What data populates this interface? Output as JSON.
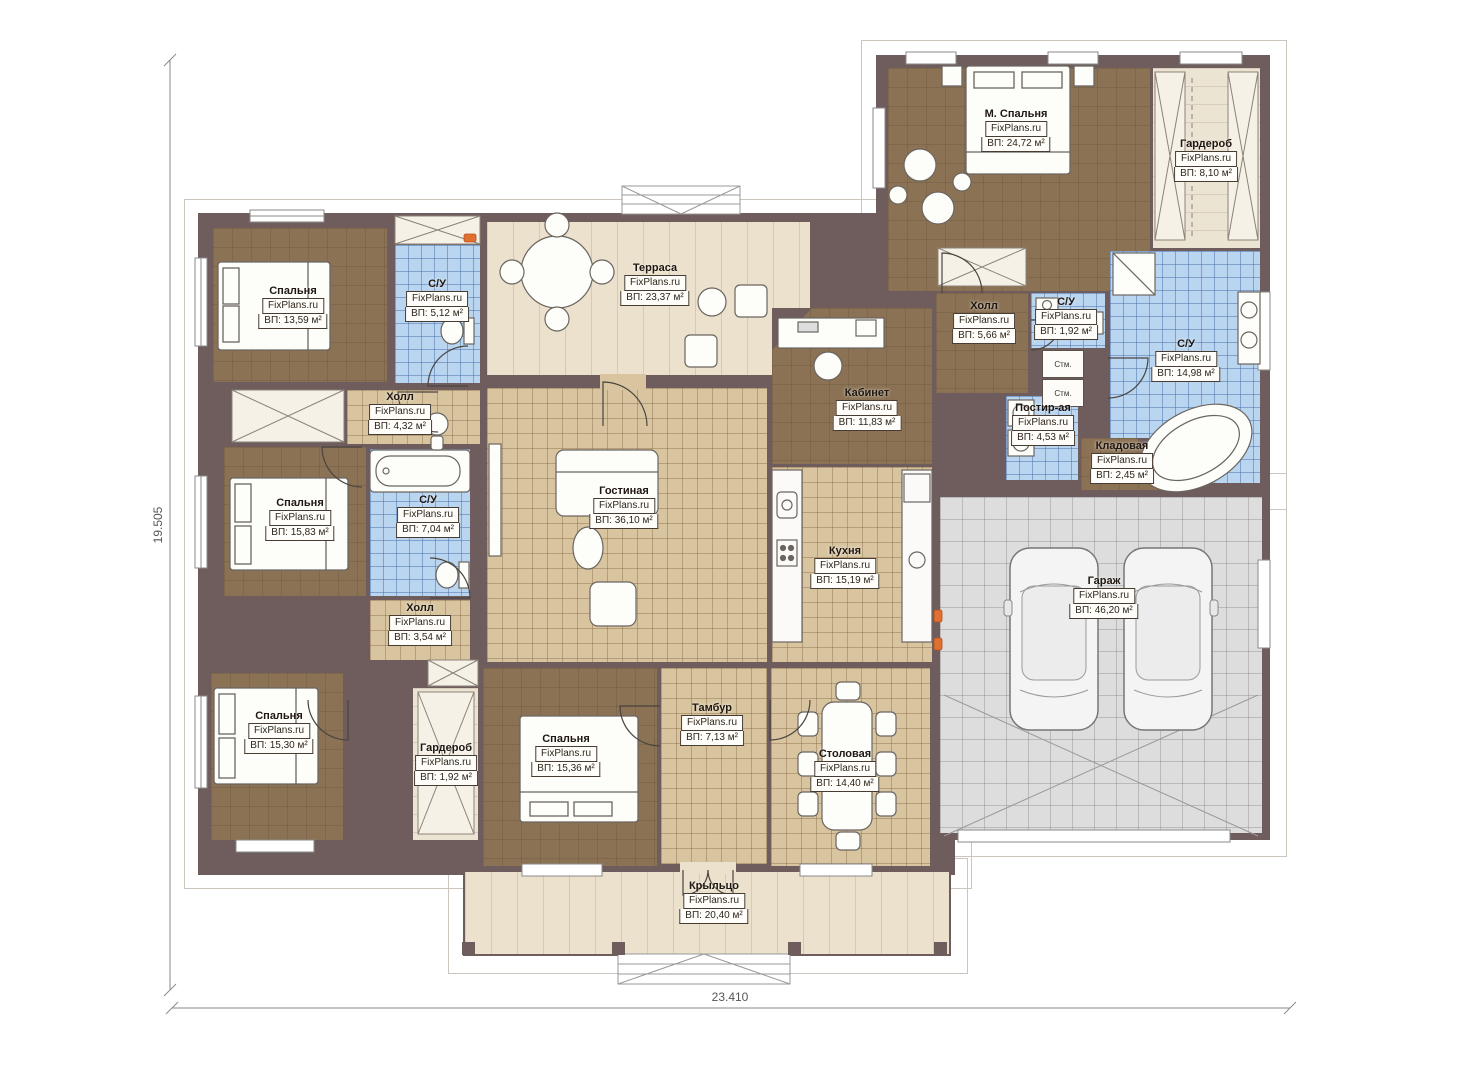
{
  "meta": {
    "watermark": "FixPlans.ru",
    "plan_type": "floor-plan"
  },
  "dimensions": {
    "left": "19.505",
    "bottom": "23.410"
  },
  "appliances": [
    {
      "label": "Стм."
    },
    {
      "label": "Стм."
    }
  ],
  "colors": {
    "wall": "#6f5c5c",
    "wood_floor": "#8b7254",
    "tile_blue": "#b9d5f0",
    "tile_tan": "#d8c5a0",
    "terrace": "#ebe1cc",
    "garage": "#dddddd",
    "accent_radiator": "#e07030"
  },
  "rooms": [
    {
      "id": "bedroom-top-left",
      "name": "Спальня",
      "area": "ВП: 13,59 м²",
      "floor": "wood",
      "x": 213,
      "y": 228,
      "w": 174,
      "h": 154,
      "lx": 293,
      "ly": 285
    },
    {
      "id": "bathroom-top-left",
      "name": "С/У",
      "area": "ВП: 5,12 м²",
      "floor": "blue",
      "x": 395,
      "y": 245,
      "w": 85,
      "h": 138,
      "lx": 437,
      "ly": 278
    },
    {
      "id": "terrace",
      "name": "Терраса",
      "area": "ВП: 23,37 м²",
      "floor": "terrace",
      "x": 487,
      "y": 222,
      "w": 323,
      "h": 153,
      "lx": 655,
      "ly": 262
    },
    {
      "id": "master-bedroom",
      "name": "М. Спальня",
      "area": "ВП: 24,72 м²",
      "floor": "wood",
      "x": 888,
      "y": 68,
      "w": 262,
      "h": 223,
      "lx": 1016,
      "ly": 108
    },
    {
      "id": "wardrobe-top-right",
      "name": "Гардероб",
      "area": "ВП: 8,10 м²",
      "floor": "light",
      "x": 1153,
      "y": 68,
      "w": 107,
      "h": 180,
      "lx": 1206,
      "ly": 138
    },
    {
      "id": "bathroom-right",
      "name": "С/У",
      "area": "ВП: 14,98 м²",
      "floor": "blue",
      "x": 1110,
      "y": 251,
      "w": 150,
      "h": 232,
      "lx": 1186,
      "ly": 338
    },
    {
      "id": "hall-top-right",
      "name": "Холл",
      "area": "ВП: 5,66 м²",
      "floor": "wood",
      "x": 936,
      "y": 293,
      "w": 92,
      "h": 100,
      "lx": 984,
      "ly": 300
    },
    {
      "id": "bathroom-small",
      "name": "С/У",
      "area": "ВП: 1,92 м²",
      "floor": "blue",
      "x": 1031,
      "y": 293,
      "w": 74,
      "h": 55,
      "lx": 1066,
      "ly": 296
    },
    {
      "id": "laundry",
      "name": "Постир-ая",
      "area": "ВП: 4,53 м²",
      "floor": "blue",
      "x": 1006,
      "y": 396,
      "w": 72,
      "h": 84,
      "lx": 1043,
      "ly": 402
    },
    {
      "id": "storage",
      "name": "Кладовая",
      "area": "ВП: 2,45 м²",
      "floor": "wood",
      "x": 1081,
      "y": 438,
      "w": 84,
      "h": 52,
      "lx": 1122,
      "ly": 440
    },
    {
      "id": "office",
      "name": "Кабинет",
      "area": "ВП: 11,83 м²",
      "floor": "wood",
      "x": 772,
      "y": 308,
      "w": 160,
      "h": 156,
      "lx": 867,
      "ly": 387
    },
    {
      "id": "living-room",
      "name": "Гостиная",
      "area": "ВП: 36,10 м²",
      "floor": "tan",
      "x": 487,
      "y": 388,
      "w": 280,
      "h": 274,
      "lx": 624,
      "ly": 485
    },
    {
      "id": "kitchen",
      "name": "Кухня",
      "area": "ВП: 15,19 м²",
      "floor": "tan",
      "x": 772,
      "y": 467,
      "w": 160,
      "h": 195,
      "lx": 845,
      "ly": 545
    },
    {
      "id": "hall-middle",
      "name": "Холл",
      "area": "ВП: 4,32 м²",
      "floor": "tan",
      "x": 347,
      "y": 390,
      "w": 133,
      "h": 54,
      "lx": 400,
      "ly": 391
    },
    {
      "id": "bedroom-middle-left",
      "name": "Спальня",
      "area": "ВП: 15,83 м²",
      "floor": "wood",
      "x": 224,
      "y": 447,
      "w": 142,
      "h": 149,
      "lx": 300,
      "ly": 497
    },
    {
      "id": "bathroom-middle",
      "name": "С/У",
      "area": "ВП: 7,04 м²",
      "floor": "blue",
      "x": 370,
      "y": 449,
      "w": 100,
      "h": 147,
      "lx": 428,
      "ly": 494
    },
    {
      "id": "hall-bottom-left",
      "name": "Холл",
      "area": "ВП: 3,54 м²",
      "floor": "tan",
      "x": 370,
      "y": 600,
      "w": 100,
      "h": 60,
      "lx": 420,
      "ly": 602
    },
    {
      "id": "bedroom-bottom-left",
      "name": "Спальня",
      "area": "ВП: 15,30 м²",
      "floor": "wood",
      "x": 211,
      "y": 673,
      "w": 132,
      "h": 167,
      "lx": 279,
      "ly": 710
    },
    {
      "id": "wardrobe-bottom",
      "name": "Гардероб",
      "area": "ВП: 1,92 м²",
      "floor": "light",
      "x": 413,
      "y": 688,
      "w": 65,
      "h": 152,
      "lx": 446,
      "ly": 742
    },
    {
      "id": "bedroom-bottom-center",
      "name": "Спальня",
      "area": "ВП: 15,36 м²",
      "floor": "wood",
      "x": 483,
      "y": 668,
      "w": 174,
      "h": 198,
      "lx": 566,
      "ly": 733
    },
    {
      "id": "vestibule",
      "name": "Тамбур",
      "area": "ВП: 7,13 м²",
      "floor": "tan",
      "x": 661,
      "y": 668,
      "w": 106,
      "h": 196,
      "lx": 712,
      "ly": 702
    },
    {
      "id": "dining-room",
      "name": "Столовая",
      "area": "ВП: 14,40 м²",
      "floor": "tan",
      "x": 771,
      "y": 668,
      "w": 159,
      "h": 198,
      "lx": 845,
      "ly": 748
    },
    {
      "id": "garage",
      "name": "Гараж",
      "area": "ВП: 46,20 м²",
      "floor": "gray",
      "x": 940,
      "y": 497,
      "w": 322,
      "h": 336,
      "lx": 1104,
      "ly": 575
    },
    {
      "id": "porch",
      "name": "Крыльцо",
      "area": "ВП: 20,40 м²",
      "floor": "terrace",
      "x": 465,
      "y": 872,
      "w": 484,
      "h": 82,
      "lx": 714,
      "ly": 880
    }
  ]
}
